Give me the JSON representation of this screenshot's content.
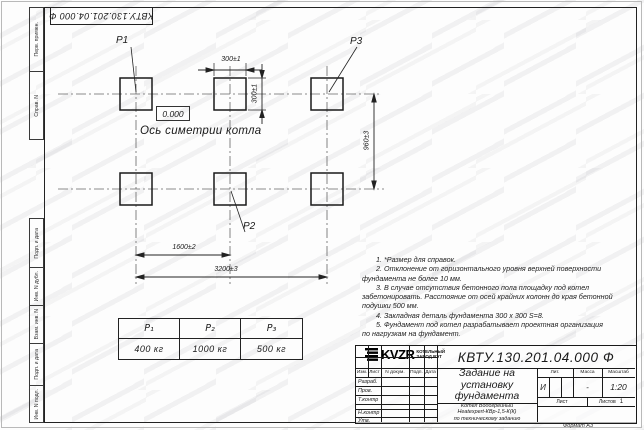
{
  "frame": {
    "docnum_top": "КВТУ.130.201.04.000 Ф",
    "margin_labels": [
      "Перв. примен.",
      "Справ. N",
      "Подп. и дата",
      "Инв. N дубл.",
      "Взам. инв. N",
      "Подп. и дата",
      "Инв. N подл."
    ],
    "format_label": "Формат А3"
  },
  "drawing": {
    "p1": "P1",
    "p2": "P2",
    "p3": "P3",
    "elevation": "0.000",
    "axis_label": "Ось симетрии котла",
    "dims": {
      "top_width": "300±1",
      "top_height": "300±1",
      "row_spacing": "960±3",
      "half_span": "1600±2",
      "full_span": "3200±3"
    }
  },
  "notes": {
    "lines": [
      "1. *Размер для справок.",
      "2. Отклонение от горизонтального уровня верхней поверхности",
      "фундамента не более 10 мм.",
      "3. В случае отсутствия бетонного пола площадку под котел",
      "забетонировать. Расстояние от осей крайних колонн до края бетонной",
      "подушки 500 мм.",
      "4. Закладная деталь фундамента 300 x 300 S=8.",
      "5. Фундамент под котел разрабатывает проектная организация",
      "по нагрузкам на фундамент."
    ]
  },
  "load_table": {
    "headers": [
      "P₁",
      "P₂",
      "P₃"
    ],
    "values": [
      "400 кг",
      "1000 кг",
      "500 кг"
    ]
  },
  "title_block": {
    "doc_number": "КВТУ.130.201.04.000 Ф",
    "title_lines": [
      "Задание на",
      "установку",
      "фундамента"
    ],
    "product_lines": [
      "Котел Водогрейный",
      "Heatexpert-КВр-1,5-К(К)",
      "по техническому заданию"
    ],
    "header_cols": [
      "Изм.",
      "Лист",
      "N докум.",
      "Подп.",
      "Дата"
    ],
    "sign_labels": [
      "Разраб.",
      "Пров.",
      "Т.контр",
      "Н.контр",
      "Утв."
    ],
    "lit_label": "Лит.",
    "lit_value": "И",
    "mass_label": "Масса",
    "mass_value": "-",
    "scale_label": "Масштаб",
    "scale_value": "1:20",
    "sheet_label": "Лист",
    "sheets_label": "Листов",
    "sheets_value": "1",
    "company": {
      "logo_text": "KVZR",
      "name_line1": "КОТЕЛЬНЫЙ",
      "name_line2": "ЗАВОД РЭТ"
    }
  }
}
